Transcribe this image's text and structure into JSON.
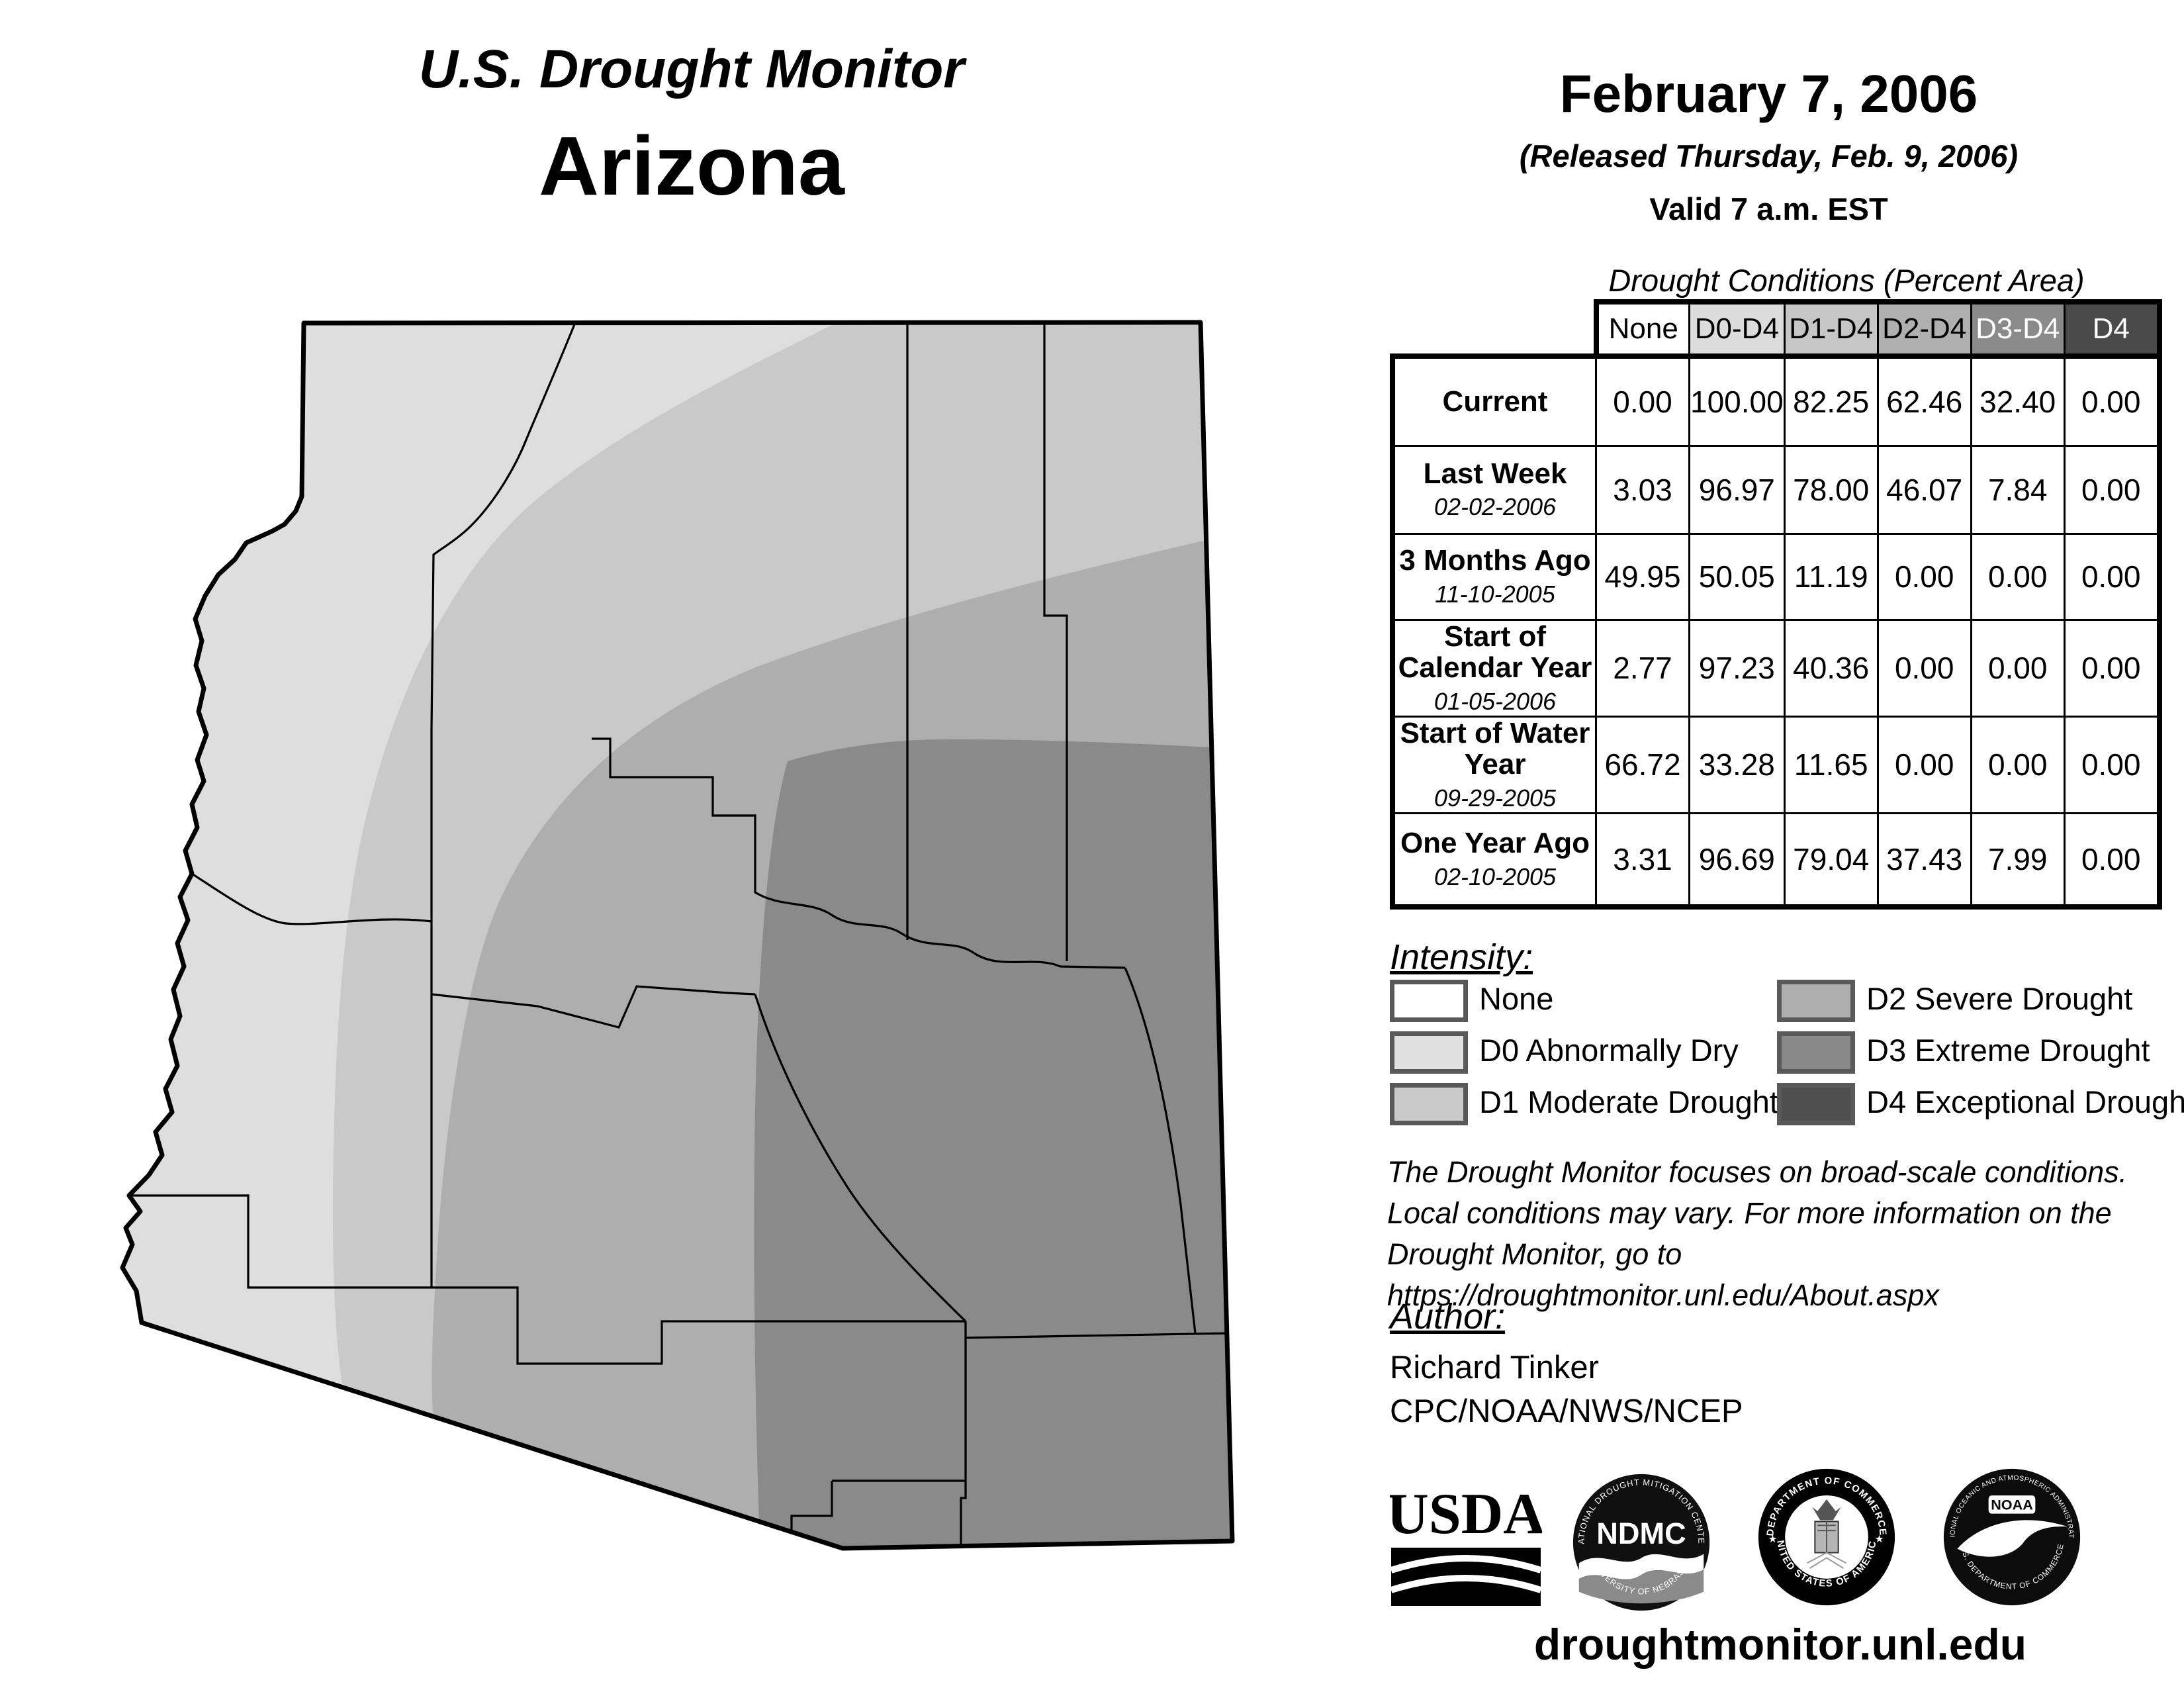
{
  "map_title": {
    "program": "U.S. Drought Monitor",
    "region": "Arizona"
  },
  "header": {
    "date": "February 7, 2006",
    "released": "(Released Thursday, Feb. 9, 2006)",
    "valid": "Valid 7 a.m. EST"
  },
  "table": {
    "caption": "Drought Conditions (Percent Area)",
    "columns": [
      "None",
      "D0-D4",
      "D1-D4",
      "D2-D4",
      "D3-D4",
      "D4"
    ],
    "column_fills": [
      "#ffffff",
      "#dcdcdc",
      "#c6c6c6",
      "#b0b0b0",
      "#8a8a8a",
      "#4a4a4a"
    ],
    "column_text_colors": [
      "#000000",
      "#000000",
      "#000000",
      "#000000",
      "#ffffff",
      "#ffffff"
    ],
    "rows": [
      {
        "label": "Current",
        "date": "",
        "values": [
          "0.00",
          "100.00",
          "82.25",
          "62.46",
          "32.40",
          "0.00"
        ]
      },
      {
        "label": "Last Week",
        "date": "02-02-2006",
        "values": [
          "3.03",
          "96.97",
          "78.00",
          "46.07",
          "7.84",
          "0.00"
        ]
      },
      {
        "label": "3 Months Ago",
        "date": "11-10-2005",
        "values": [
          "49.95",
          "50.05",
          "11.19",
          "0.00",
          "0.00",
          "0.00"
        ]
      },
      {
        "label": "Start of Calendar Year",
        "date": "01-05-2006",
        "values": [
          "2.77",
          "97.23",
          "40.36",
          "0.00",
          "0.00",
          "0.00"
        ]
      },
      {
        "label": "Start of Water Year",
        "date": "09-29-2005",
        "values": [
          "66.72",
          "33.28",
          "11.65",
          "0.00",
          "0.00",
          "0.00"
        ]
      },
      {
        "label": "One Year Ago",
        "date": "02-10-2005",
        "values": [
          "3.31",
          "96.69",
          "79.04",
          "37.43",
          "7.99",
          "0.00"
        ]
      }
    ]
  },
  "legend": {
    "title": "Intensity:",
    "items": [
      {
        "label": "None",
        "color": "#ffffff"
      },
      {
        "label": "D0 Abnormally Dry",
        "color": "#e0e0e0"
      },
      {
        "label": "D1 Moderate Drought",
        "color": "#c9c9c9"
      },
      {
        "label": "D2 Severe Drought",
        "color": "#aeaeae"
      },
      {
        "label": "D3 Extreme Drought",
        "color": "#898989"
      },
      {
        "label": "D4 Exceptional Drought",
        "color": "#4f4f4f"
      }
    ]
  },
  "note_lines": [
    "The Drought Monitor focuses on broad-scale conditions.",
    "Local conditions may vary. For more information on the",
    "Drought Monitor, go to https://droughtmonitor.unl.edu/About.aspx"
  ],
  "author": {
    "title": "Author:",
    "name": "Richard Tinker",
    "org": "CPC/NOAA/NWS/NCEP"
  },
  "logos": {
    "usda": "USDA",
    "ndmc": "NDMC",
    "ndmc_top": "NATIONAL DROUGHT MITIGATION CENTER",
    "ndmc_bottom": "UNIVERSITY OF NEBRASKA",
    "doc_top": "DEPARTMENT OF COMMERCE",
    "doc_bottom": "UNITED STATES OF AMERICA",
    "noaa": "NOAA",
    "noaa_top": "NATIONAL OCEANIC AND ATMOSPHERIC ADMINISTRATION",
    "noaa_bottom": "U.S. DEPARTMENT OF COMMERCE"
  },
  "footer": {
    "url": "droughtmonitor.unl.edu"
  },
  "map": {
    "palette": {
      "d0": "#dedede",
      "d1": "#c9c9c9",
      "d2": "#aeaeae",
      "d3": "#8a8a8a"
    },
    "classes_shown": [
      "D0",
      "D1",
      "D2",
      "D3"
    ]
  }
}
